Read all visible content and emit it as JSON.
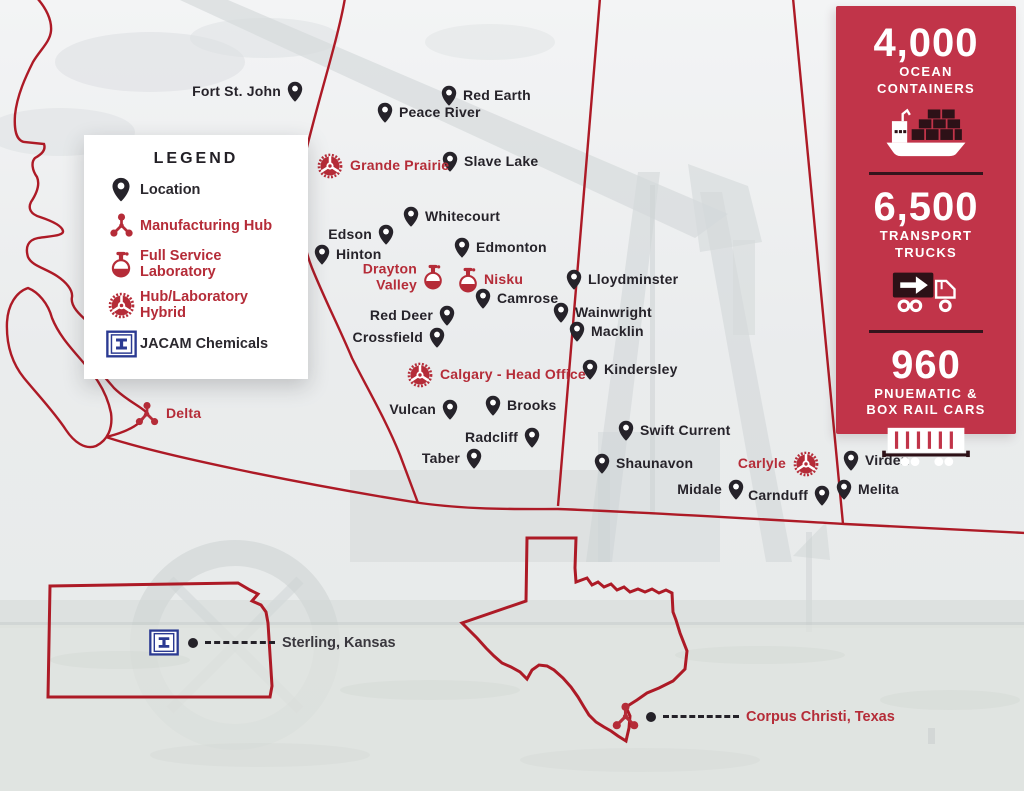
{
  "title": "JACAM Chemicals locations map",
  "colors": {
    "panel_red": "#c13449",
    "border_red": "#ad1a26",
    "text_red": "#b52c38",
    "pin_black": "#26232a",
    "jacam_blue": "#2b3a92",
    "text_dark": "#3a383e",
    "divider_dark": "#33141c"
  },
  "legend": {
    "title": "LEGEND",
    "items": [
      {
        "label": "Location",
        "icon": "pin"
      },
      {
        "label": "Manufacturing Hub",
        "icon": "hub"
      },
      {
        "label": "Full Service Laboratory",
        "icon": "flask"
      },
      {
        "label": "Hub/Laboratory Hybrid",
        "icon": "hybrid"
      },
      {
        "label": "JACAM Chemicals",
        "icon": "jacam"
      }
    ]
  },
  "stats": [
    {
      "value": "4,000",
      "lines": [
        "OCEAN",
        "CONTAINERS"
      ],
      "icon": "ship"
    },
    {
      "value": "6,500",
      "lines": [
        "TRANSPORT",
        "TRUCKS"
      ],
      "icon": "truck"
    },
    {
      "value": "960",
      "lines": [
        "PNUEMATIC &",
        "BOX RAIL CARS"
      ],
      "icon": "railcar"
    }
  ],
  "map": {
    "markers": [
      {
        "label": "Fort St. John",
        "x": 295,
        "y": 92,
        "type": "pin",
        "side": "left"
      },
      {
        "label": "Red Earth",
        "x": 449,
        "y": 96,
        "type": "pin",
        "side": "right"
      },
      {
        "label": "Peace River",
        "x": 385,
        "y": 113,
        "type": "pin",
        "side": "right"
      },
      {
        "label": "Slave Lake",
        "x": 450,
        "y": 162,
        "type": "pin",
        "side": "right"
      },
      {
        "label": "Grande Prairie",
        "x": 330,
        "y": 166,
        "type": "hybrid",
        "side": "right"
      },
      {
        "label": "Whitecourt",
        "x": 411,
        "y": 217,
        "type": "pin",
        "side": "right"
      },
      {
        "label": "Edson",
        "x": 386,
        "y": 235,
        "type": "pin",
        "side": "left"
      },
      {
        "label": "Hinton",
        "x": 322,
        "y": 255,
        "type": "pin",
        "side": "right"
      },
      {
        "label": "Edmonton",
        "x": 462,
        "y": 248,
        "type": "pin",
        "side": "right"
      },
      {
        "label": "Drayton Valley",
        "lines": [
          "Drayton",
          "Valley"
        ],
        "x": 433,
        "y": 277,
        "type": "flask",
        "side": "left"
      },
      {
        "label": "Nisku",
        "x": 468,
        "y": 280,
        "type": "flask",
        "side": "right"
      },
      {
        "label": "Lloydminster",
        "x": 574,
        "y": 280,
        "type": "pin",
        "side": "right"
      },
      {
        "label": "Camrose",
        "x": 483,
        "y": 299,
        "type": "pin",
        "side": "right"
      },
      {
        "label": "Wainwright",
        "x": 561,
        "y": 313,
        "type": "pin",
        "side": "right"
      },
      {
        "label": "Red Deer",
        "x": 447,
        "y": 316,
        "type": "pin",
        "side": "left"
      },
      {
        "label": "Macklin",
        "x": 577,
        "y": 332,
        "type": "pin",
        "side": "right"
      },
      {
        "label": "Crossfield",
        "x": 437,
        "y": 338,
        "type": "pin",
        "side": "left"
      },
      {
        "label": "Kindersley",
        "x": 590,
        "y": 370,
        "type": "pin",
        "side": "right"
      },
      {
        "label": "Calgary - Head Office",
        "x": 420,
        "y": 375,
        "type": "hybrid",
        "side": "right"
      },
      {
        "label": "Brooks",
        "x": 493,
        "y": 406,
        "type": "pin",
        "side": "right"
      },
      {
        "label": "Vulcan",
        "x": 450,
        "y": 410,
        "type": "pin",
        "side": "left"
      },
      {
        "label": "Delta",
        "x": 147,
        "y": 414,
        "type": "hub",
        "side": "right"
      },
      {
        "label": "Swift Current",
        "x": 626,
        "y": 431,
        "type": "pin",
        "side": "right"
      },
      {
        "label": "Radcliff",
        "x": 532,
        "y": 438,
        "type": "pin",
        "side": "left"
      },
      {
        "label": "Taber",
        "x": 474,
        "y": 459,
        "type": "pin",
        "side": "left"
      },
      {
        "label": "Virden",
        "x": 851,
        "y": 461,
        "type": "pin",
        "side": "right"
      },
      {
        "label": "Carlyle",
        "x": 806,
        "y": 464,
        "type": "hybrid",
        "side": "left"
      },
      {
        "label": "Shaunavon",
        "x": 602,
        "y": 464,
        "type": "pin",
        "side": "right"
      },
      {
        "label": "Melita",
        "x": 844,
        "y": 490,
        "type": "pin",
        "side": "right"
      },
      {
        "label": "Midale",
        "x": 736,
        "y": 490,
        "type": "pin",
        "side": "left"
      },
      {
        "label": "Carnduff",
        "x": 822,
        "y": 496,
        "type": "pin",
        "side": "left"
      }
    ]
  },
  "insets": {
    "kansas": {
      "label": "Sterling, Kansas"
    },
    "texas": {
      "label": "Corpus Christi, Texas"
    }
  }
}
